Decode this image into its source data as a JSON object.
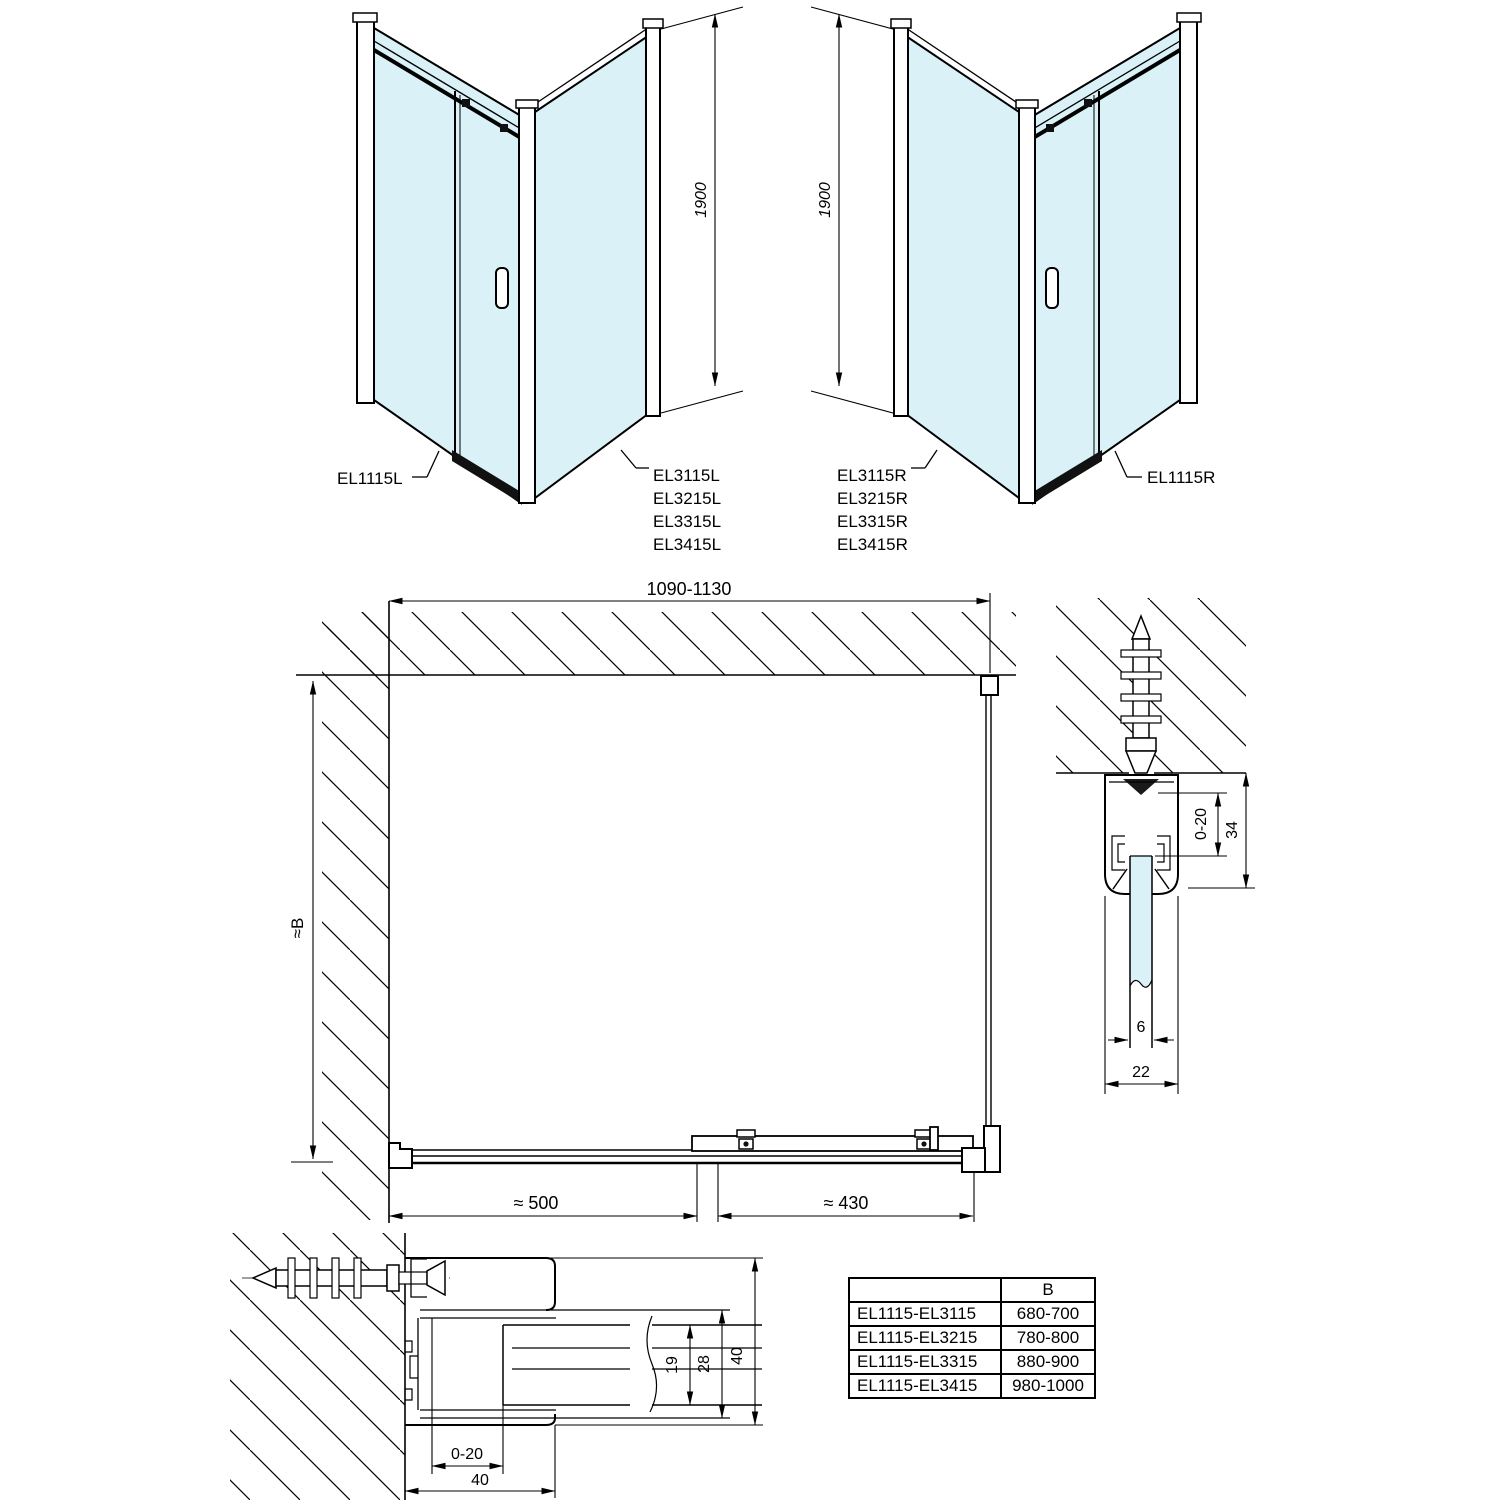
{
  "colors": {
    "line": "#000000",
    "glass": "#d9f1f7"
  },
  "iso_left": {
    "door_label": "EL1115L",
    "side_labels": [
      "EL3115L",
      "EL3215L",
      "EL3315L",
      "EL3415L"
    ],
    "height_dim": "1900"
  },
  "iso_right": {
    "door_label": "EL1115R",
    "side_labels": [
      "EL3115R",
      "EL3215R",
      "EL3315R",
      "EL3415R"
    ],
    "height_dim": "1900"
  },
  "plan": {
    "width_dim": "1090-1130",
    "depth_dim": "≈B",
    "fixed_panel_dim": "≈ 500",
    "door_dim": "≈ 430"
  },
  "wall_profile_section": {
    "adjustment_dim": "0-20",
    "profile_depth_dim": "34",
    "glass_thickness_dim": "6",
    "profile_width_dim": "22"
  },
  "floor_profile_section": {
    "adjustment_dim": "0-20",
    "profile_depth_dim": "40",
    "panel_thickness_dim": "19",
    "pocket_depth_dim": "28",
    "profile_height_dim": "40"
  },
  "size_table": {
    "headers": [
      "",
      "B"
    ],
    "rows": [
      [
        "EL1115-EL3115",
        "680-700"
      ],
      [
        "EL1115-EL3215",
        "780-800"
      ],
      [
        "EL1115-EL3315",
        "880-900"
      ],
      [
        "EL1115-EL3415",
        "980-1000"
      ]
    ]
  }
}
